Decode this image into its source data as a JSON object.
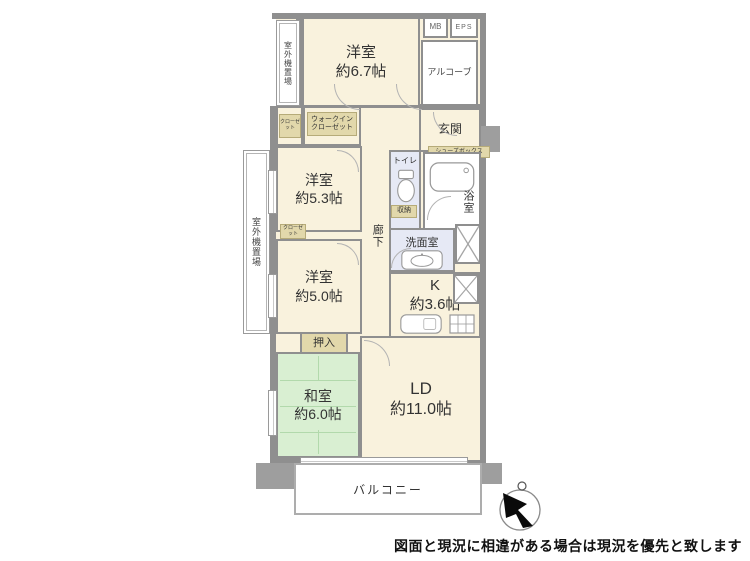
{
  "colors": {
    "wall": "#8f8f8f",
    "room_cream": "#f9f2dd",
    "tatami_green": "#d9efd2",
    "wet_lavender": "#e6e9f5",
    "closet_tan": "#e2d8ab",
    "column_gray": "#9e9e9e"
  },
  "rooms": {
    "western1": {
      "name": "洋室",
      "size": "約6.7帖"
    },
    "western2": {
      "name": "洋室",
      "size": "約5.3帖"
    },
    "western3": {
      "name": "洋室",
      "size": "約5.0帖"
    },
    "japanese": {
      "name": "和室",
      "size": "約6.0帖"
    },
    "living": {
      "name": "LD",
      "size": "約11.0帖"
    },
    "kitchen": {
      "name": "K",
      "size": "約3.6帖"
    }
  },
  "labels": {
    "outdoor_unit_top": "室外機置場",
    "outdoor_unit_left": "室外機置場",
    "mb": "MB",
    "eps": "EPS",
    "alcove": "アルコーブ",
    "entrance": "玄関",
    "walk_in_closet": "ウォークインクローゼット",
    "closet": "クローゼット",
    "shoe_box": "シューズボックス",
    "toilet": "トイレ",
    "bathroom": "浴室",
    "storage": "収納",
    "corridor": "廊下",
    "washroom": "洗面室",
    "oshiire": "押入",
    "balcony": "バルコニー"
  },
  "footer": {
    "disclaimer": "図面と現況に相違がある場合は現況を優先と致します"
  }
}
